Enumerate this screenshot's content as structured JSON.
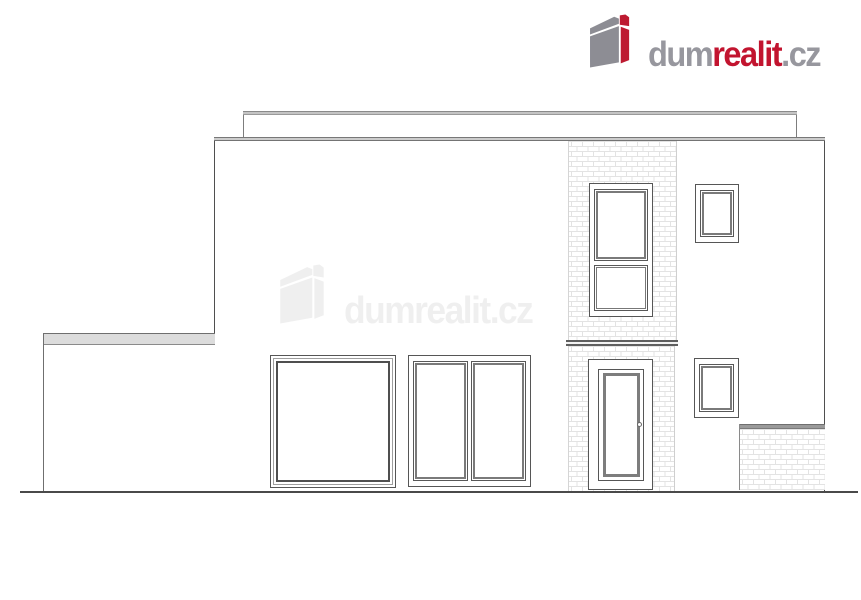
{
  "page": {
    "background_color": "#ffffff",
    "content_type": "real-estate listing image: architectural front elevation drawing with agency watermark"
  },
  "header_logo": {
    "icon_name": "building-icon",
    "segments": [
      {
        "text": "dum",
        "color": "#97979e"
      },
      {
        "text": "realit",
        "color": "#c2142f"
      },
      {
        "text": ".cz",
        "color": "#97979e"
      }
    ],
    "icon_colors": {
      "gray": "#8d8d94",
      "red": "#bd1a31"
    }
  },
  "watermark": {
    "segments": [
      {
        "text": "dum"
      },
      {
        "text": "realit"
      },
      {
        "text": ".cz"
      }
    ],
    "opacity": 0.13,
    "color": "#8a8a8a"
  },
  "elevation": {
    "line_color": "#4f4f4f",
    "brick_mortar_color": "#e3e3e3",
    "coping_gray": "#9a9a9a",
    "slab_gray": "#cccccc",
    "elements": [
      "flat-roof attic parapet",
      "main facade wall",
      "low left boundary wall with light-gray coping",
      "vertical clinker-brick pier",
      "inter-floor lintel band",
      "tall two-part upper window",
      "small upper-right window",
      "large fixed ground-floor window",
      "double casement ground-floor window",
      "small lower-right window",
      "glazed entrance door with round handle",
      "low right clinker-brick wall with dark coping",
      "ground line"
    ]
  }
}
